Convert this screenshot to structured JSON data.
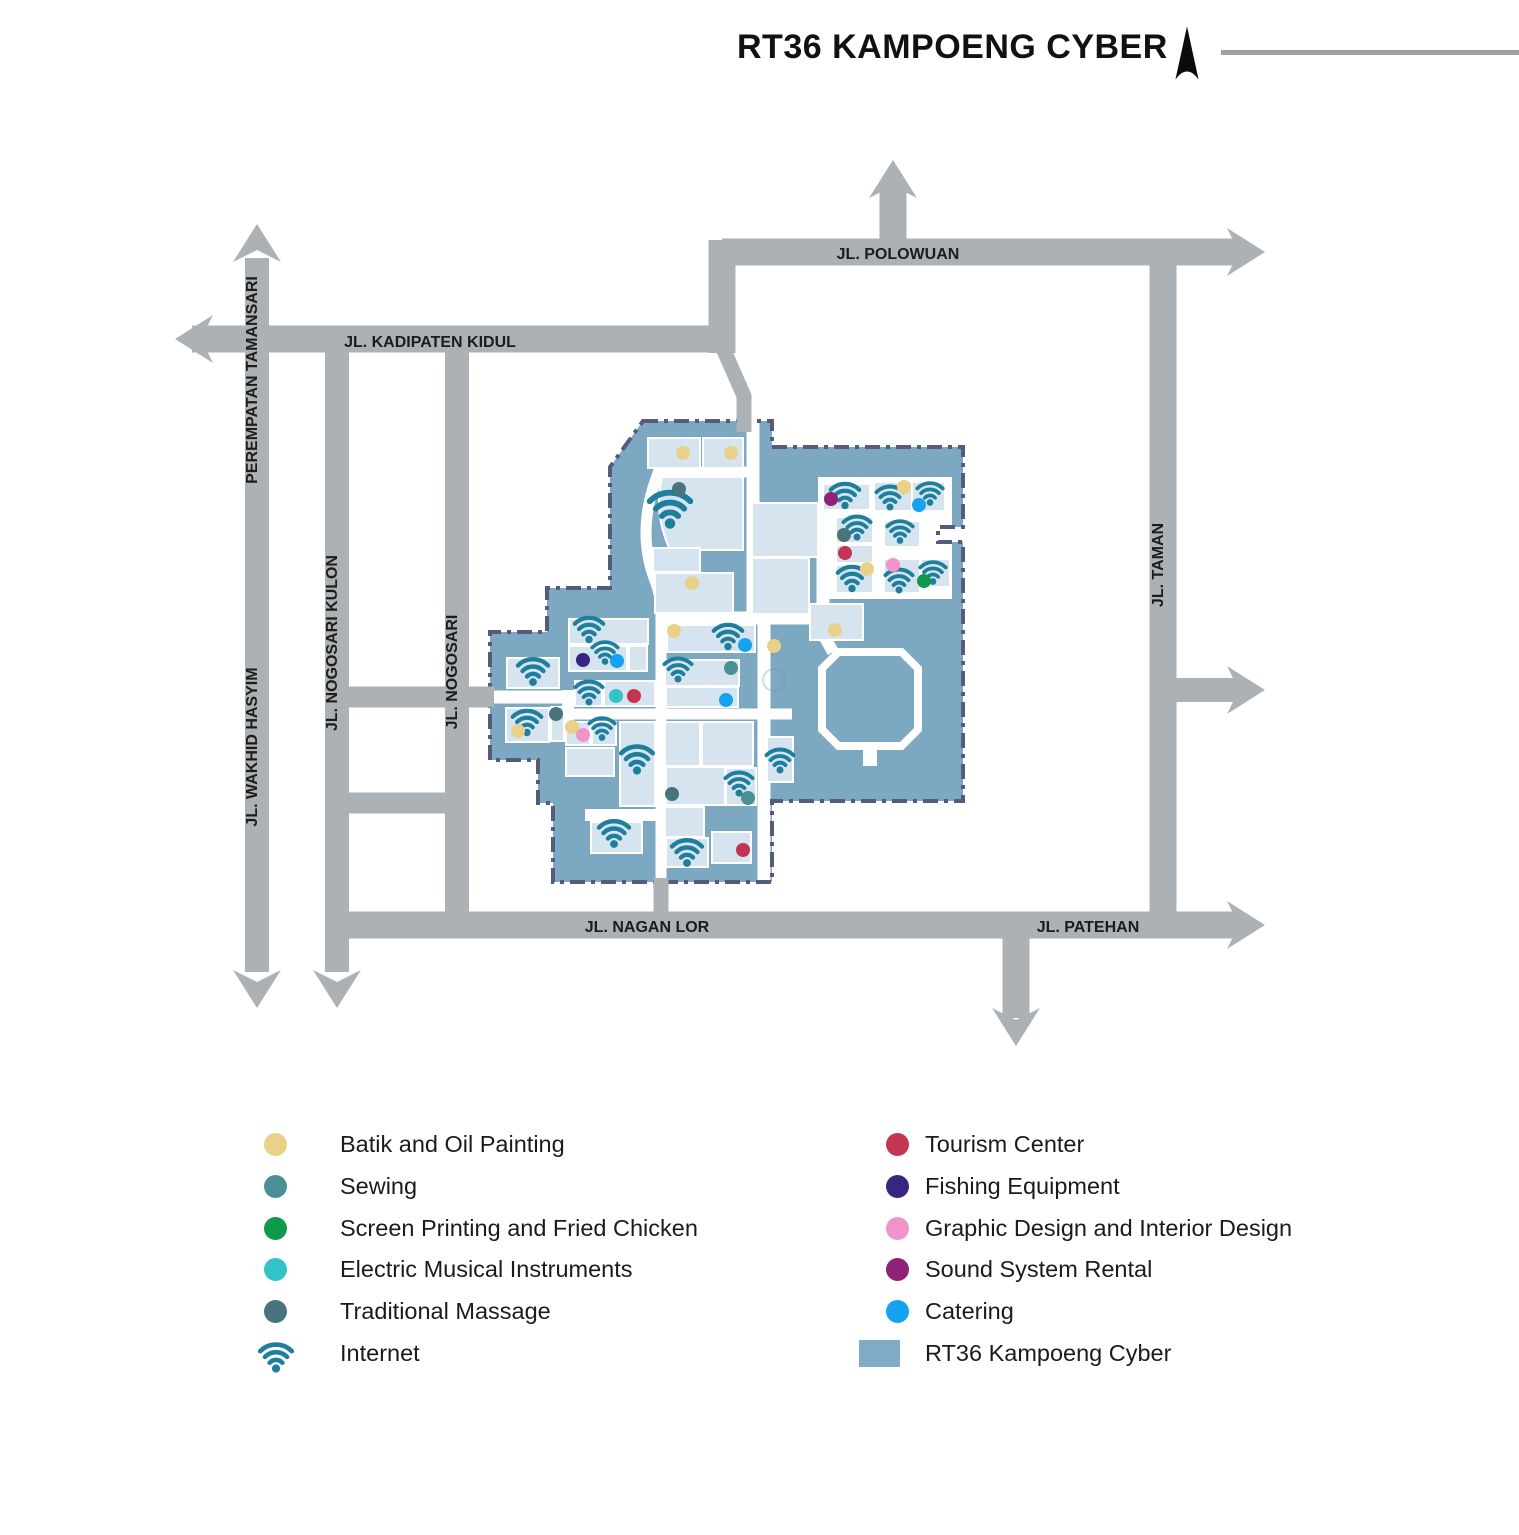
{
  "title": "RT36 KAMPOENG CYBER",
  "colors": {
    "road": "#ABB1B5",
    "road_label": "#1C1C1C",
    "title_line": "#9BA1A5",
    "north_arrow": "#0b0b0b",
    "kampoeng_fill": "#7CA8C1",
    "kampoeng_border": "#565A7D",
    "building_fill": "#D6E4EF",
    "building_stroke": "#FFFFFF",
    "wifi": "#1E7E9C"
  },
  "legend": {
    "left": [
      {
        "id": "batik",
        "label": "Batik and Oil Painting",
        "color": "#E9D189",
        "type": "dot"
      },
      {
        "id": "sewing",
        "label": "Sewing",
        "color": "#4A8E96",
        "type": "dot"
      },
      {
        "id": "screen-printing",
        "label": "Screen Printing and Fried Chicken",
        "color": "#0D9B4B",
        "type": "dot"
      },
      {
        "id": "electric-music",
        "label": "Electric Musical Instruments",
        "color": "#32C3C8",
        "type": "dot"
      },
      {
        "id": "massage",
        "label": "Traditional Massage",
        "color": "#48757B",
        "type": "dot"
      },
      {
        "id": "internet",
        "label": "Internet",
        "color": "#1E7E9C",
        "type": "wifi"
      }
    ],
    "right": [
      {
        "id": "tourism",
        "label": "Tourism Center",
        "color": "#C43551",
        "type": "dot"
      },
      {
        "id": "fishing",
        "label": "Fishing Equipment",
        "color": "#392581",
        "type": "dot"
      },
      {
        "id": "graphic-design",
        "label": "Graphic Design and Interior Design",
        "color": "#F093C9",
        "type": "dot"
      },
      {
        "id": "sound-system",
        "label": "Sound System Rental",
        "color": "#8F2277",
        "type": "dot"
      },
      {
        "id": "catering",
        "label": "Catering",
        "color": "#15A2EF",
        "type": "dot"
      },
      {
        "id": "area",
        "label": "RT36 Kampoeng Cyber",
        "color": "#7FABC6",
        "type": "square"
      }
    ]
  },
  "roads": {
    "segments": [
      {
        "id": "perempatan-tamansari",
        "pts": [
          [
            257,
            258
          ],
          [
            257,
            972
          ]
        ],
        "w": 24
      },
      {
        "id": "kadipaten-kidul",
        "pts": [
          [
            192,
            339
          ],
          [
            735,
            339
          ]
        ],
        "w": 27
      },
      {
        "id": "polowuan",
        "pts": [
          [
            722,
            252
          ],
          [
            1245,
            252
          ]
        ],
        "w": 27
      },
      {
        "id": "polowuan-elbow",
        "pts": [
          [
            722,
            240
          ],
          [
            722,
            353
          ]
        ],
        "w": 27
      },
      {
        "id": "polowuan-north-branch",
        "pts": [
          [
            893,
            252
          ],
          [
            893,
            182
          ]
        ],
        "w": 27
      },
      {
        "id": "kampoeng-access-north",
        "pts": [
          [
            722,
            346
          ],
          [
            744,
            396
          ],
          [
            744,
            432
          ]
        ],
        "w": 15,
        "layer": "over"
      },
      {
        "id": "nogosari-kulon",
        "pts": [
          [
            337,
            339
          ],
          [
            337,
            972
          ]
        ],
        "w": 24
      },
      {
        "id": "nogosari",
        "pts": [
          [
            457,
            339
          ],
          [
            457,
            930
          ]
        ],
        "w": 24
      },
      {
        "id": "nogosari-connector",
        "pts": [
          [
            337,
            697
          ],
          [
            494,
            697
          ]
        ],
        "w": 21,
        "layer": "over"
      },
      {
        "id": "nogosari-connector-south",
        "pts": [
          [
            337,
            803
          ],
          [
            457,
            803
          ]
        ],
        "w": 21
      },
      {
        "id": "nagan-lor-patehan",
        "pts": [
          [
            337,
            925
          ],
          [
            1243,
            925
          ]
        ],
        "w": 27
      },
      {
        "id": "taman",
        "pts": [
          [
            1163,
            252
          ],
          [
            1163,
            925
          ]
        ],
        "w": 27
      },
      {
        "id": "taman-east-branch",
        "pts": [
          [
            1176,
            690
          ],
          [
            1243,
            690
          ]
        ],
        "w": 24
      },
      {
        "id": "patehan-south-branch",
        "pts": [
          [
            1016,
            938
          ],
          [
            1016,
            1018
          ]
        ],
        "w": 27
      },
      {
        "id": "kampoeng-access-south",
        "pts": [
          [
            661,
            878
          ],
          [
            661,
            925
          ]
        ],
        "w": 15,
        "layer": "over"
      }
    ],
    "arrows": [
      {
        "dir": "up",
        "x": 257,
        "y": 224
      },
      {
        "dir": "up",
        "x": 893,
        "y": 160
      },
      {
        "dir": "down",
        "x": 257,
        "y": 1008
      },
      {
        "dir": "down",
        "x": 337,
        "y": 1008
      },
      {
        "dir": "down",
        "x": 1016,
        "y": 1046
      },
      {
        "dir": "left",
        "x": 175,
        "y": 339
      },
      {
        "dir": "right",
        "x": 1265,
        "y": 252
      },
      {
        "dir": "right",
        "x": 1265,
        "y": 690
      },
      {
        "dir": "right",
        "x": 1265,
        "y": 925
      }
    ],
    "labels": [
      {
        "id": "perempatan-tamansari",
        "text": "PEREMPATAN TAMANSARI",
        "x": 257,
        "y": 380,
        "rot": -90
      },
      {
        "id": "wakhid-hasyim",
        "text": "JL. WAKHID HASYIM",
        "x": 257,
        "y": 747,
        "rot": -90
      },
      {
        "id": "nogosari-kulon",
        "text": "JL. NOGOSARI KULON",
        "x": 337,
        "y": 643,
        "rot": -90
      },
      {
        "id": "nogosari",
        "text": "JL. NOGOSARI",
        "x": 457,
        "y": 672,
        "rot": -90
      },
      {
        "id": "taman",
        "text": "JL. TAMAN",
        "x": 1163,
        "y": 565,
        "rot": -90
      },
      {
        "id": "kadipaten-kidul",
        "text": "JL. KADIPATEN KIDUL",
        "x": 430,
        "y": 347,
        "rot": 0
      },
      {
        "id": "polowuan",
        "text": "JL. POLOWUAN",
        "x": 898,
        "y": 259,
        "rot": 0
      },
      {
        "id": "nagan-lor",
        "text": "JL. NAGAN LOR",
        "x": 647,
        "y": 932,
        "rot": 0
      },
      {
        "id": "patehan",
        "text": "JL. PATEHAN",
        "x": 1088,
        "y": 932,
        "rot": 0
      }
    ]
  },
  "map": {
    "outline": [
      [
        643,
        421
      ],
      [
        772,
        421
      ],
      [
        772,
        447
      ],
      [
        963,
        447
      ],
      [
        963,
        527
      ],
      [
        938,
        527
      ],
      [
        938,
        542
      ],
      [
        963,
        542
      ],
      [
        963,
        801
      ],
      [
        772,
        801
      ],
      [
        772,
        882
      ],
      [
        553,
        882
      ],
      [
        553,
        803
      ],
      [
        538,
        803
      ],
      [
        538,
        760
      ],
      [
        490,
        760
      ],
      [
        490,
        632
      ],
      [
        547,
        632
      ],
      [
        547,
        588
      ],
      [
        610,
        588
      ],
      [
        610,
        467
      ]
    ],
    "streets": [
      {
        "d": "M 661,466 C 644,505 641,542 654,578 C 660,594 661,602 661,616 L 661,882",
        "w": 11
      },
      {
        "d": "M 753,421 L 753,624",
        "w": 13
      },
      {
        "d": "M 655,472 L 753,472",
        "w": 11
      },
      {
        "d": "M 661,618 L 818,618",
        "w": 13
      },
      {
        "d": "M 764,618 L 764,882",
        "w": 13
      },
      {
        "d": "M 490,697 L 568,697",
        "w": 13
      },
      {
        "d": "M 568,690 L 568,722",
        "w": 12
      },
      {
        "d": "M 562,714 L 792,714",
        "w": 11
      },
      {
        "d": "M 585,815 L 661,815",
        "w": 12
      },
      {
        "d": "M 814,618 L 833,652",
        "w": 12
      },
      {
        "d": "M 823,503 L 823,615",
        "w": 13
      }
    ],
    "pads": [
      [
        818,
        477,
        134,
        122
      ]
    ],
    "octagon": {
      "outer": [
        [
          837,
          648
        ],
        [
          903,
          648
        ],
        [
          922,
          667
        ],
        [
          922,
          731
        ],
        [
          903,
          750
        ],
        [
          837,
          750
        ],
        [
          818,
          731
        ],
        [
          818,
          667
        ]
      ],
      "inner": [
        [
          840,
          656
        ],
        [
          900,
          656
        ],
        [
          914,
          670
        ],
        [
          914,
          728
        ],
        [
          900,
          742
        ],
        [
          840,
          742
        ],
        [
          826,
          728
        ],
        [
          826,
          670
        ]
      ],
      "stub": [
        863,
        748,
        14,
        18
      ]
    },
    "curved_building": "M 697,477 L 743,477 L 743,550 L 670,550 Q 653,512 662,477 Z",
    "buildings": [
      [
        648,
        438,
        52,
        30
      ],
      [
        703,
        438,
        40,
        30
      ],
      [
        653,
        548,
        47,
        24
      ],
      [
        655,
        573,
        78,
        40
      ],
      [
        752,
        503,
        66,
        54
      ],
      [
        752,
        558,
        57,
        56
      ],
      [
        810,
        604,
        53,
        36
      ],
      [
        823,
        484,
        47,
        26
      ],
      [
        874,
        482,
        38,
        29
      ],
      [
        912,
        482,
        33,
        29
      ],
      [
        836,
        517,
        37,
        26
      ],
      [
        884,
        521,
        36,
        26
      ],
      [
        836,
        545,
        37,
        18
      ],
      [
        836,
        565,
        37,
        28
      ],
      [
        884,
        559,
        36,
        34
      ],
      [
        921,
        559,
        29,
        28
      ],
      [
        569,
        619,
        79,
        25
      ],
      [
        667,
        625,
        88,
        27
      ],
      [
        665,
        660,
        74,
        26
      ],
      [
        666,
        687,
        72,
        20
      ],
      [
        569,
        646,
        58,
        25
      ],
      [
        629,
        646,
        18,
        25
      ],
      [
        507,
        658,
        52,
        30
      ],
      [
        575,
        681,
        27,
        25
      ],
      [
        604,
        681,
        51,
        25
      ],
      [
        506,
        708,
        43,
        34
      ],
      [
        551,
        707,
        13,
        34
      ],
      [
        566,
        722,
        24,
        23
      ],
      [
        592,
        722,
        24,
        23
      ],
      [
        566,
        748,
        48,
        28
      ],
      [
        620,
        722,
        35,
        84
      ],
      [
        591,
        822,
        51,
        31
      ],
      [
        665,
        722,
        35,
        44
      ],
      [
        702,
        722,
        51,
        44
      ],
      [
        666,
        767,
        59,
        38
      ],
      [
        726,
        768,
        30,
        37
      ],
      [
        665,
        807,
        39,
        30
      ],
      [
        666,
        838,
        42,
        29
      ],
      [
        712,
        832,
        39,
        31
      ],
      [
        767,
        737,
        26,
        45
      ]
    ],
    "wifi": [
      [
        670,
        510,
        1.35
      ],
      [
        533,
        672,
        1.0
      ],
      [
        589,
        630,
        0.95
      ],
      [
        728,
        637,
        0.95
      ],
      [
        605,
        653,
        0.85
      ],
      [
        589,
        693,
        0.9
      ],
      [
        602,
        729,
        0.85
      ],
      [
        527,
        723,
        0.95
      ],
      [
        637,
        760,
        1.05
      ],
      [
        614,
        834,
        1.0
      ],
      [
        687,
        853,
        1.0
      ],
      [
        678,
        670,
        0.9
      ],
      [
        739,
        784,
        0.9
      ],
      [
        780,
        761,
        0.9
      ],
      [
        845,
        496,
        0.95
      ],
      [
        890,
        498,
        0.9
      ],
      [
        930,
        494,
        0.85
      ],
      [
        857,
        528,
        0.9
      ],
      [
        900,
        532,
        0.85
      ],
      [
        852,
        579,
        0.95
      ],
      [
        899,
        581,
        0.9
      ],
      [
        933,
        573,
        0.85
      ]
    ],
    "faint_ring": {
      "x": 774,
      "y": 680,
      "r": 11
    },
    "dots": [
      {
        "cat": "batik",
        "x": 683,
        "y": 453
      },
      {
        "cat": "batik",
        "x": 731,
        "y": 453
      },
      {
        "cat": "batik",
        "x": 692,
        "y": 583
      },
      {
        "cat": "batik",
        "x": 904,
        "y": 487
      },
      {
        "cat": "batik",
        "x": 867,
        "y": 569
      },
      {
        "cat": "batik",
        "x": 835,
        "y": 630
      },
      {
        "cat": "batik",
        "x": 674,
        "y": 631
      },
      {
        "cat": "batik",
        "x": 774,
        "y": 646
      },
      {
        "cat": "batik",
        "x": 518,
        "y": 731
      },
      {
        "cat": "batik",
        "x": 572,
        "y": 727
      },
      {
        "cat": "sewing",
        "x": 731,
        "y": 668
      },
      {
        "cat": "sewing",
        "x": 748,
        "y": 798
      },
      {
        "cat": "screen-printing",
        "x": 924,
        "y": 581
      },
      {
        "cat": "electric-music",
        "x": 616,
        "y": 696
      },
      {
        "cat": "massage",
        "x": 679,
        "y": 489
      },
      {
        "cat": "massage",
        "x": 844,
        "y": 535
      },
      {
        "cat": "massage",
        "x": 556,
        "y": 714
      },
      {
        "cat": "massage",
        "x": 672,
        "y": 794
      },
      {
        "cat": "tourism",
        "x": 634,
        "y": 696
      },
      {
        "cat": "tourism",
        "x": 845,
        "y": 553
      },
      {
        "cat": "tourism",
        "x": 743,
        "y": 850
      },
      {
        "cat": "fishing",
        "x": 583,
        "y": 660
      },
      {
        "cat": "graphic-design",
        "x": 583,
        "y": 735
      },
      {
        "cat": "graphic-design",
        "x": 893,
        "y": 565
      },
      {
        "cat": "sound-system",
        "x": 831,
        "y": 499
      },
      {
        "cat": "catering",
        "x": 617,
        "y": 661
      },
      {
        "cat": "catering",
        "x": 745,
        "y": 645
      },
      {
        "cat": "catering",
        "x": 726,
        "y": 700
      },
      {
        "cat": "catering",
        "x": 919,
        "y": 505
      }
    ]
  }
}
